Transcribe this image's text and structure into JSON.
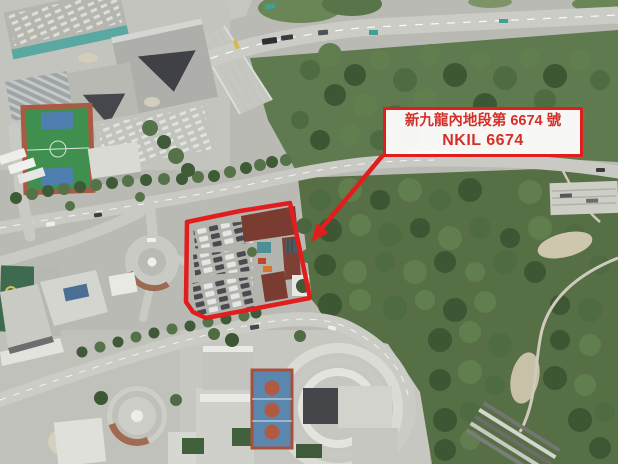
{
  "annotation": {
    "label_line1": "新九龍內地段第 6674 號",
    "label_line2": "NKIL 6674",
    "colors": {
      "annotation_red": "#e21d1e",
      "label_text_red": "#d43029",
      "label_box_bg": "#ffffff"
    }
  }
}
